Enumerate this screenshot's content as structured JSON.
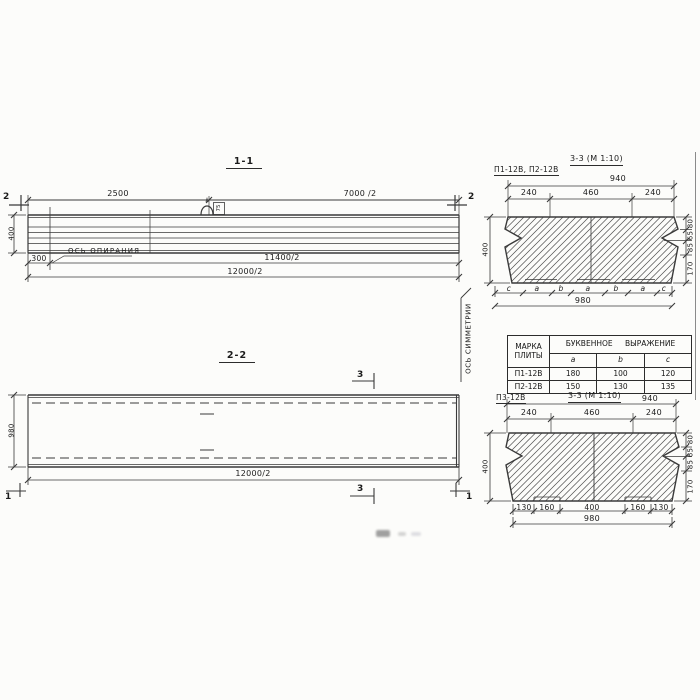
{
  "meta": {
    "ink": "#3a3a3a",
    "paper": "#fcfcfa"
  },
  "section1": {
    "title": "1-1",
    "cut_mark": "2",
    "dim_2500": "2500",
    "dim_7000": "7000 /2",
    "dim_height": "400",
    "dim_300": "300",
    "support_axis": "ОСЬ ОПИРАНИЯ",
    "dim_11400": "11400/2",
    "dim_12000": "12000/2",
    "loop_dim": "75"
  },
  "section2": {
    "title": "2-2",
    "cut_mark_3": "3",
    "cut_mark_1": "1",
    "dim_height": "980",
    "dim_width": "12000/2",
    "symmetry_axis": "ОСЬ СИММЕТРИИ"
  },
  "cs_top": {
    "label": "П1-12В, П2-12В",
    "title": "3-3 (М 1:10)",
    "dim_940": "940",
    "top_dims": [
      "240",
      "460",
      "240"
    ],
    "dim_height": "400",
    "right_dims": [
      "80",
      "65",
      "85",
      "170"
    ],
    "bottom_letters": [
      "c",
      "a",
      "b",
      "a",
      "b",
      "a",
      "c"
    ],
    "dim_980": "980"
  },
  "table": {
    "col_mark": "МАРКА ПЛИТЫ",
    "col_expr": "БУКВЕННОЕ ВЫРАЖЕНИЕ",
    "sub_cols": [
      "a",
      "b",
      "c"
    ],
    "rows": [
      {
        "mark": "П1-12В",
        "a": "180",
        "b": "100",
        "c": "120"
      },
      {
        "mark": "П2-12В",
        "a": "150",
        "b": "130",
        "c": "135"
      }
    ]
  },
  "cs_bottom": {
    "label": "П3-12В",
    "title": "3-3 (М 1:10)",
    "dim_940": "940",
    "top_dims": [
      "240",
      "460",
      "240"
    ],
    "dim_height": "400",
    "right_dims": [
      "80",
      "65",
      "85",
      "170"
    ],
    "bottom_dims": [
      "130",
      "160",
      "400",
      "160",
      "130"
    ],
    "dim_980": "980"
  }
}
